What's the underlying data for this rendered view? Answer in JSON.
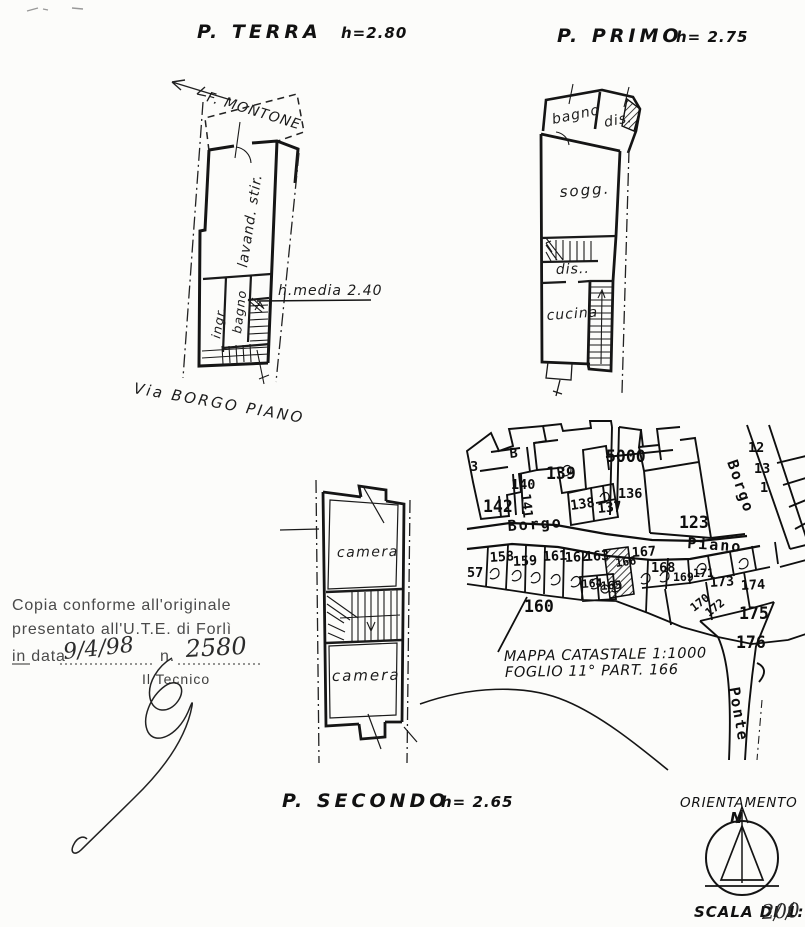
{
  "plans": {
    "terra": {
      "title": "P. TERRA",
      "height_label": "h=2.80",
      "river_label": "F. MONTONE",
      "street_label": "Via BORGO PIANO",
      "room_lavanderia": "lavand. stir.",
      "room_bagno": "bagno",
      "room_ingresso": "ingr.",
      "annotation_height": "h.media 2.40"
    },
    "primo": {
      "title": "P. PRIMO",
      "height_label": "h= 2.75",
      "room_bagno": "bagno",
      "room_dis_top": "dis.",
      "room_soggiorno": "sogg.",
      "room_dis_mid": "dis..",
      "room_cucina": "cucina"
    },
    "secondo": {
      "title": "P. SECONDO",
      "height_label": "h= 2.65",
      "room_camera_top": "camera",
      "room_camera_bottom": "camera"
    }
  },
  "map": {
    "caption_line1": "MAPPA CATASTALE 1:1000",
    "caption_line2": "FOGLIO 11° PART. 166",
    "street_borgo_horizontal": "Borgo",
    "street_piano": "Piano",
    "street_borgo_diagonal": "Borgo",
    "street_ponte": "Ponte",
    "parcels": {
      "b": "B",
      "n3": "3",
      "n12": "12",
      "n13": "13",
      "n1": "1",
      "n57": "57",
      "n123": "123",
      "n136": "136",
      "n137": "137",
      "n138": "138",
      "n139": "139",
      "n140": "140",
      "n141": "141",
      "n142": "142",
      "n158": "158",
      "n159": "159",
      "n160": "160",
      "n161": "161",
      "n162": "162",
      "n163": "163",
      "n164": "164",
      "n165": "165",
      "n166": "166",
      "n167": "167",
      "n168": "168",
      "n169": "169",
      "n170": "170",
      "n171": "171",
      "n172": "172",
      "n173": "173",
      "n174": "174",
      "n175": "175",
      "n176": "176",
      "n5000": "5000"
    }
  },
  "stamp": {
    "line1": "Copia conforme all'originale",
    "line2": "presentato all'U.T.E. di Forlì",
    "line3_prefix": "in data",
    "date_handwritten": "9/4/98",
    "number_prefix": "n.",
    "number_handwritten": "2580",
    "signer_label": "Il Tecnico"
  },
  "orientation": {
    "label": "ORIENTAMENTO",
    "north_letter": "N"
  },
  "scale": {
    "prefix": "SCALA DI 1:",
    "value": "200"
  }
}
